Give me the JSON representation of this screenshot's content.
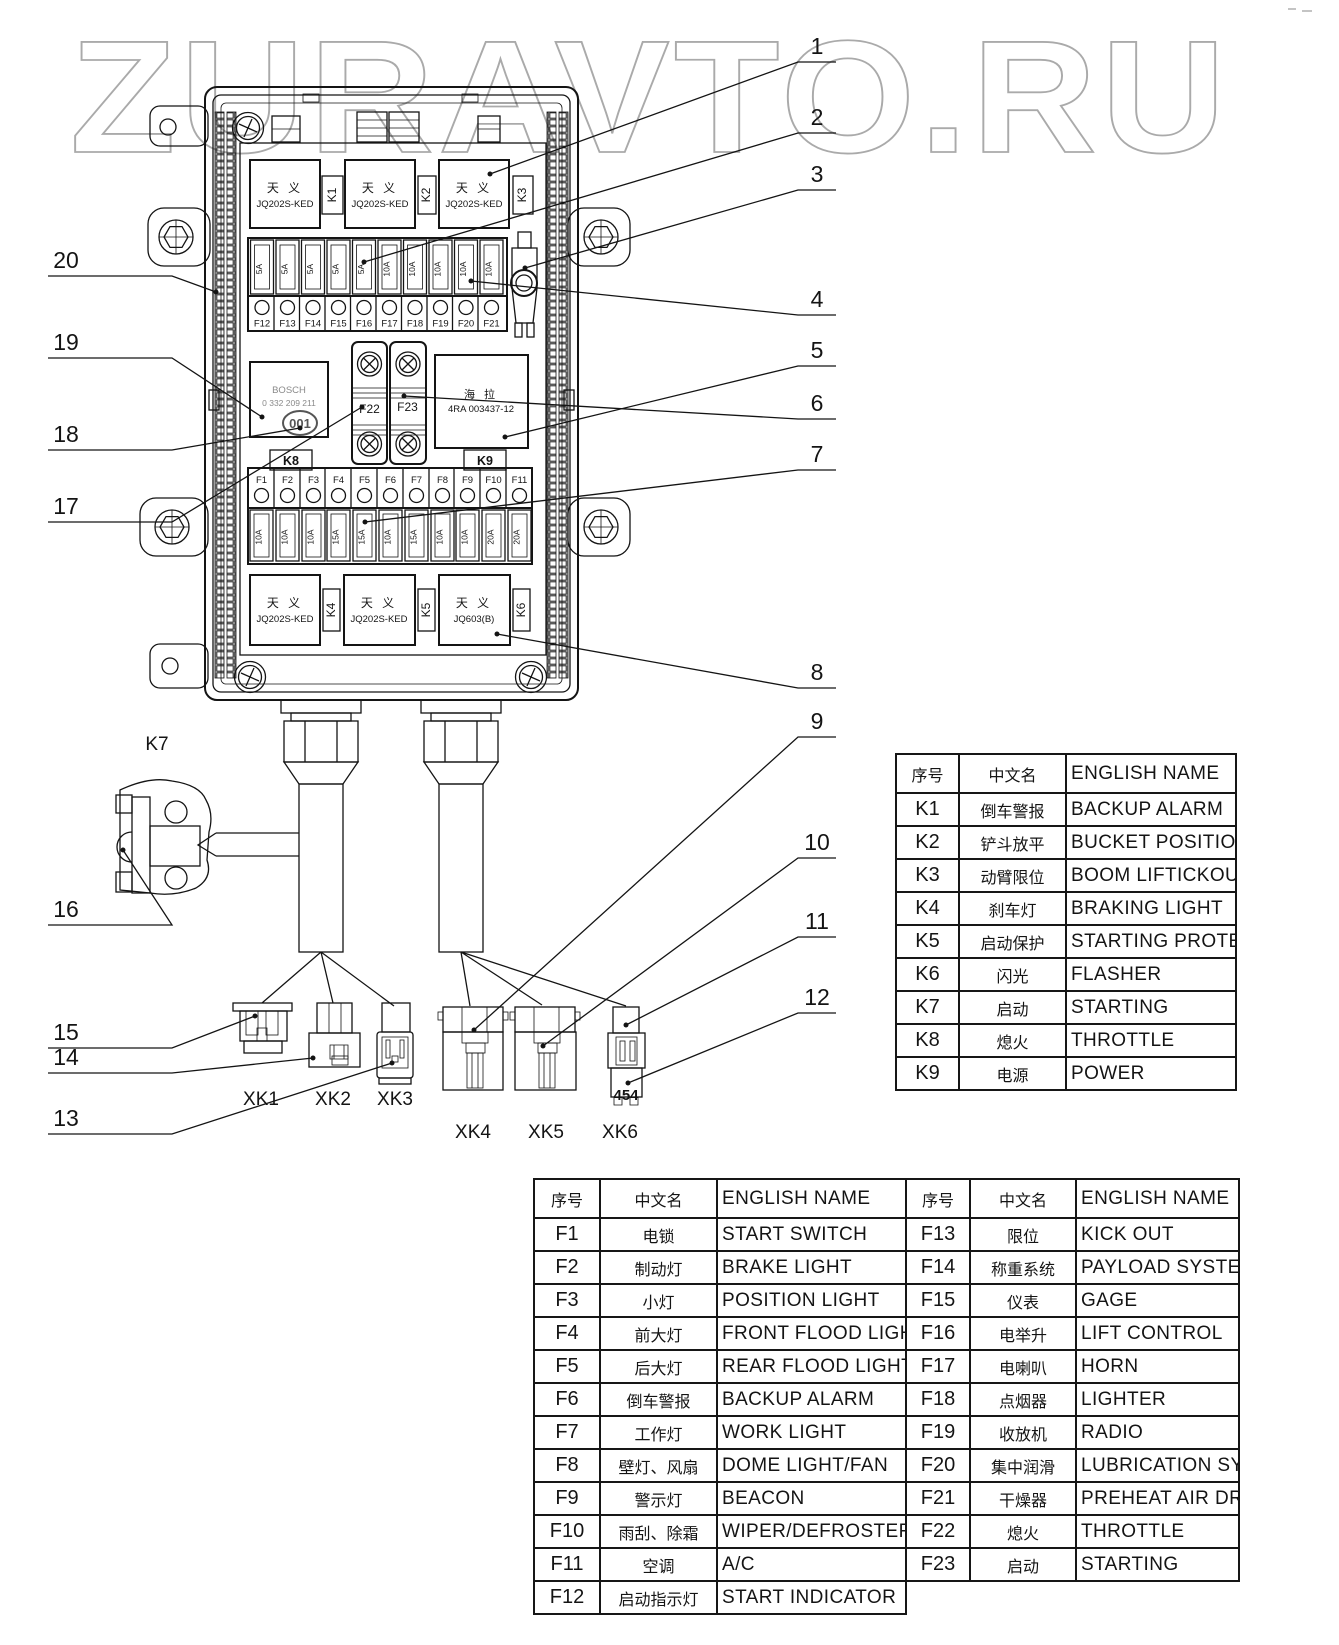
{
  "watermark": "ZURAVTO.RU",
  "diagram": {
    "relays_top": [
      {
        "brand": "天 义",
        "model": "JQ202S-KED",
        "tag": "K1"
      },
      {
        "brand": "天 义",
        "model": "JQ202S-KED",
        "tag": "K2"
      },
      {
        "brand": "天 义",
        "model": "JQ202S-KED",
        "tag": "K3"
      }
    ],
    "relays_bottom": [
      {
        "brand": "天 义",
        "model": "JQ202S-KED",
        "tag": "K4"
      },
      {
        "brand": "天 义",
        "model": "JQ202S-KED",
        "tag": "K5"
      },
      {
        "brand": "天 义",
        "model": "JQ603(B)",
        "tag": "K6"
      }
    ],
    "fuse_row_top": {
      "fuses": [
        {
          "id": "F12",
          "amp": "5A"
        },
        {
          "id": "F13",
          "amp": "5A"
        },
        {
          "id": "F14",
          "amp": "5A"
        },
        {
          "id": "F15",
          "amp": "5A"
        },
        {
          "id": "F16",
          "amp": "5A"
        },
        {
          "id": "F17",
          "amp": "10A"
        },
        {
          "id": "F18",
          "amp": "10A"
        },
        {
          "id": "F19",
          "amp": "10A"
        },
        {
          "id": "F20",
          "amp": "10A"
        },
        {
          "id": "F21",
          "amp": "10A"
        }
      ]
    },
    "fuse_row_mid": {
      "fuses": [
        {
          "id": "F1",
          "amp": "10A"
        },
        {
          "id": "F2",
          "amp": "10A"
        },
        {
          "id": "F3",
          "amp": "10A"
        },
        {
          "id": "F4",
          "amp": "15A"
        },
        {
          "id": "F5",
          "amp": "15A"
        },
        {
          "id": "F6",
          "amp": "10A"
        },
        {
          "id": "F7",
          "amp": "15A"
        },
        {
          "id": "F8",
          "amp": "10A"
        },
        {
          "id": "F9",
          "amp": "10A"
        },
        {
          "id": "F10",
          "amp": "20A"
        },
        {
          "id": "F11",
          "amp": "20A"
        }
      ]
    },
    "bosch_relay": {
      "brand": "BOSCH",
      "part": "0 332 209 211",
      "stamp": "001"
    },
    "hella_unit": {
      "brand": "海 拉",
      "part": "4RA 003437-12"
    },
    "holder_fuses": {
      "left": "F22",
      "right": "F23"
    },
    "k8_label": "K8",
    "k9_label": "K9",
    "k7_label": "K7",
    "connector_labels": [
      "XK1",
      "XK2",
      "XK3",
      "XK4",
      "XK5",
      "XK6"
    ],
    "xk6_code": "454",
    "callouts_right": [
      "1",
      "2",
      "3",
      "4",
      "5",
      "6",
      "7",
      "8",
      "9",
      "10",
      "11",
      "12"
    ],
    "callouts_left": [
      "20",
      "19",
      "18",
      "17",
      "16",
      "15",
      "14",
      "13"
    ]
  },
  "relay_table": {
    "headers": [
      "序号",
      "中文名",
      "ENGLISH NAME"
    ],
    "rows": [
      [
        "K1",
        "倒车警报",
        "BACKUP ALARM"
      ],
      [
        "K2",
        "铲斗放平",
        "BUCKET POSITIONER"
      ],
      [
        "K3",
        "动臂限位",
        "BOOM LIFTICKOUT"
      ],
      [
        "K4",
        "刹车灯",
        "BRAKING LIGHT"
      ],
      [
        "K5",
        "启动保护",
        "STARTING PROTECTION"
      ],
      [
        "K6",
        "闪光",
        "FLASHER"
      ],
      [
        "K7",
        "启动",
        "STARTING"
      ],
      [
        "K8",
        "熄火",
        "THROTTLE"
      ],
      [
        "K9",
        "电源",
        "POWER"
      ]
    ]
  },
  "fuse_table_left": {
    "headers": [
      "序号",
      "中文名",
      "ENGLISH NAME"
    ],
    "rows": [
      [
        "F1",
        "电锁",
        "START SWITCH"
      ],
      [
        "F2",
        "制动灯",
        "BRAKE LIGHT"
      ],
      [
        "F3",
        "小灯",
        "POSITION LIGHT"
      ],
      [
        "F4",
        "前大灯",
        "FRONT FLOOD LIGHT"
      ],
      [
        "F5",
        "后大灯",
        "REAR FLOOD LIGHT"
      ],
      [
        "F6",
        "倒车警报",
        "BACKUP ALARM"
      ],
      [
        "F7",
        "工作灯",
        "WORK LIGHT"
      ],
      [
        "F8",
        "壁灯、风扇",
        "DOME LIGHT/FAN"
      ],
      [
        "F9",
        "警示灯",
        "BEACON"
      ],
      [
        "F10",
        "雨刮、除霜",
        "WIPER/DEFROSTER"
      ],
      [
        "F11",
        "空调",
        "A/C"
      ],
      [
        "F12",
        "启动指示灯",
        "START INDICATOR"
      ]
    ]
  },
  "fuse_table_right": {
    "headers": [
      "序号",
      "中文名",
      "ENGLISH NAME"
    ],
    "rows": [
      [
        "F13",
        "限位",
        "KICK OUT"
      ],
      [
        "F14",
        "称重系统",
        "PAYLOAD SYSTEM"
      ],
      [
        "F15",
        "仪表",
        "GAGE"
      ],
      [
        "F16",
        "电举升",
        "LIFT CONTROL"
      ],
      [
        "F17",
        "电喇叭",
        "HORN"
      ],
      [
        "F18",
        "点烟器",
        "LIGHTER"
      ],
      [
        "F19",
        "收放机",
        "RADIO"
      ],
      [
        "F20",
        "集中润滑",
        "LUBRICATION SYSTEM"
      ],
      [
        "F21",
        "干燥器",
        "PREHEAT AIR DRYER"
      ],
      [
        "F22",
        "熄火",
        "THROTTLE"
      ],
      [
        "F23",
        "启动",
        "STARTING"
      ]
    ]
  }
}
